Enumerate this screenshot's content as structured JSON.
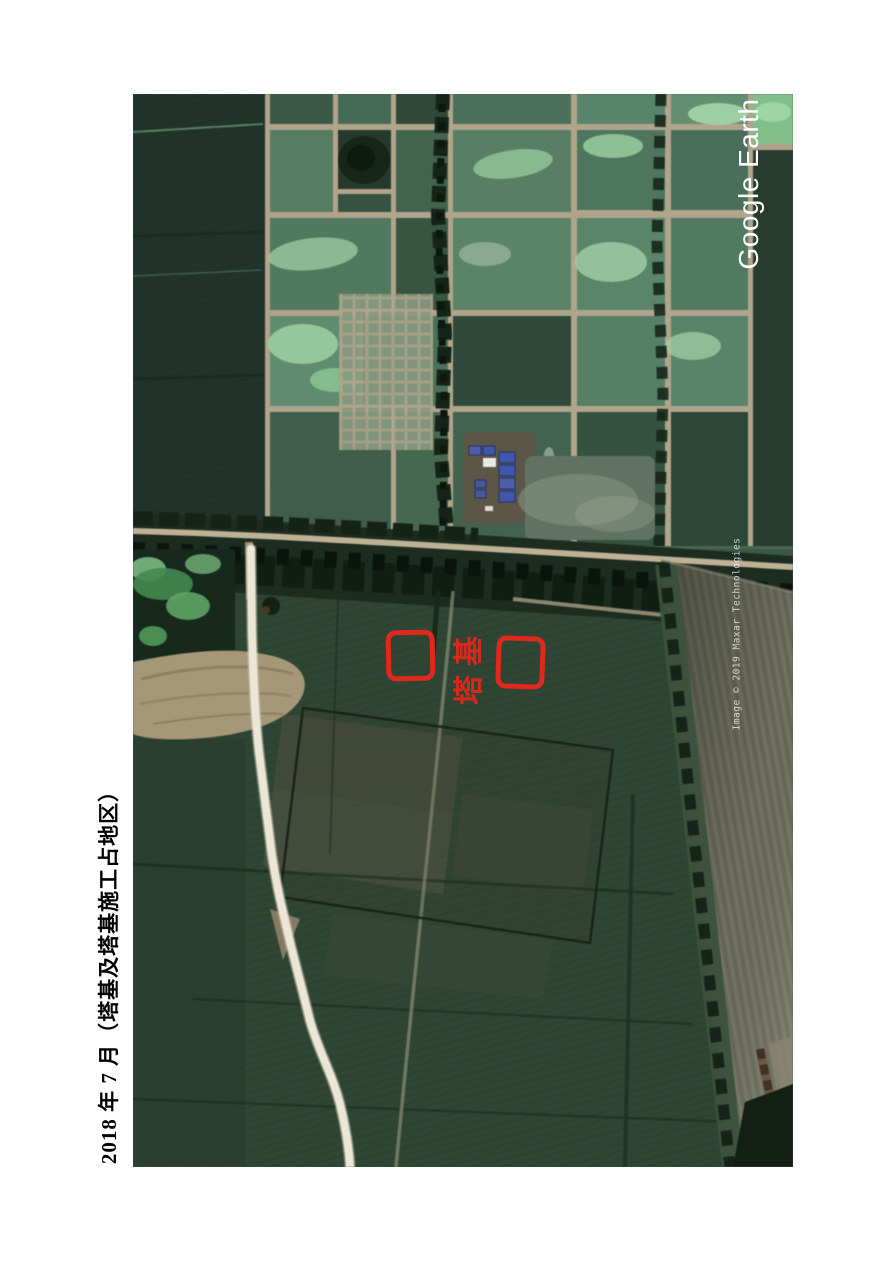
{
  "page": {
    "caption": "2018 年 7 月（塔基及塔基施工占地区）"
  },
  "map": {
    "source_label": "Google Earth",
    "watermark": "Image © 2019 Maxar Technologies",
    "annotations": {
      "label": "塔基",
      "color": "#e0281c",
      "boxes": [
        {
          "position": "left-of-label"
        },
        {
          "position": "right-of-label"
        }
      ]
    }
  }
}
